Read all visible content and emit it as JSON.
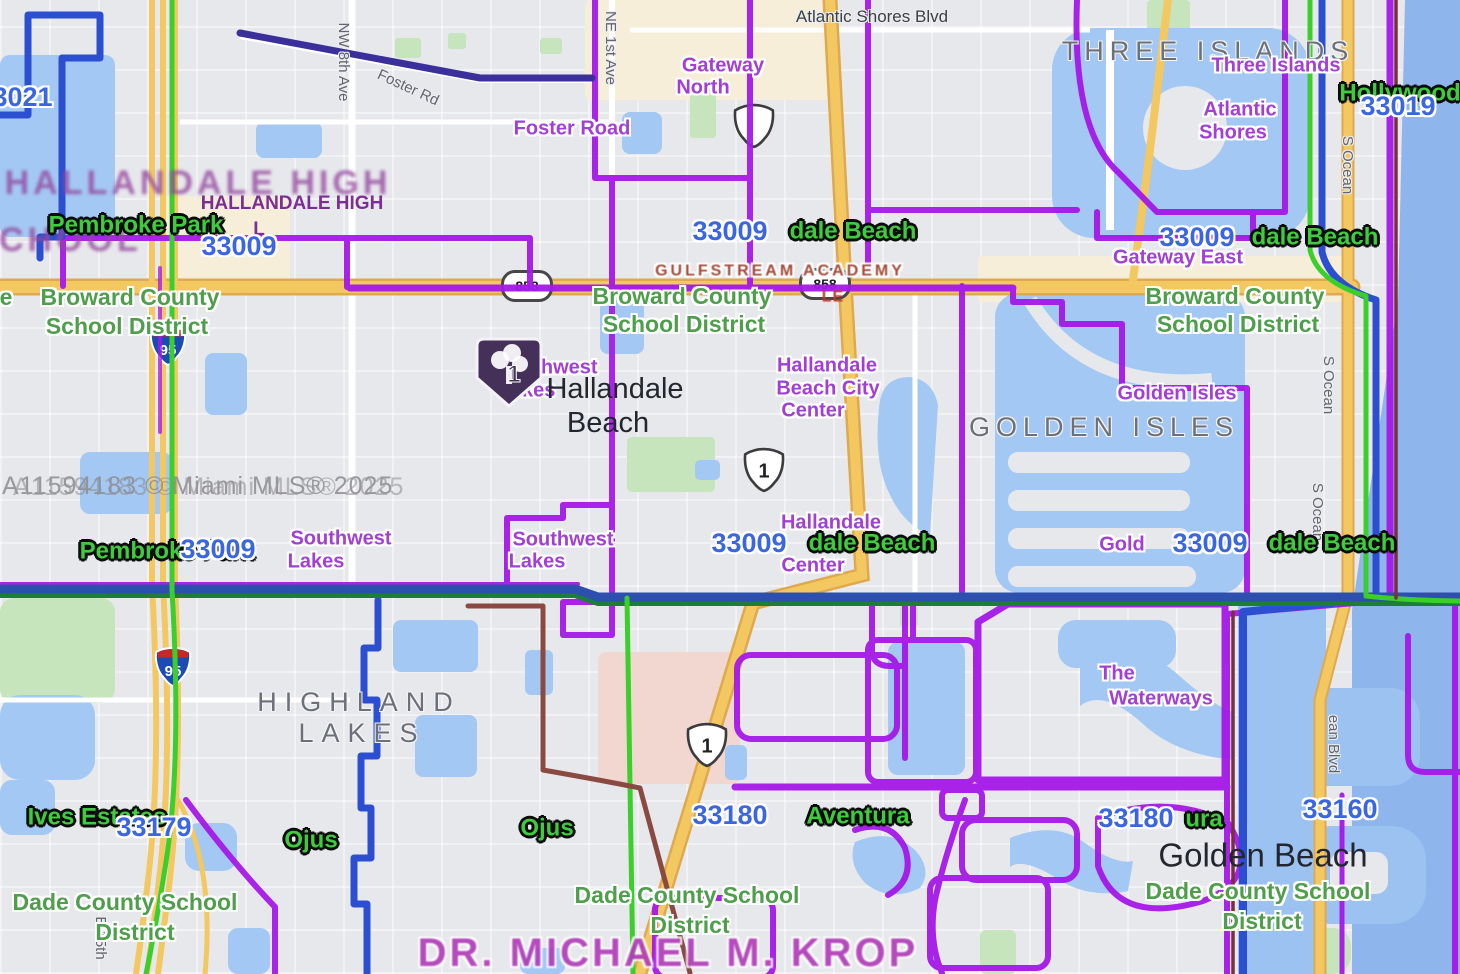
{
  "colors": {
    "zip_label": "#3a66e4",
    "city_label": "#3ecb3e",
    "school_district_label": "#4f9e4c",
    "neighborhood_label": "#a13fd6",
    "boundary_purple": "#a518e8",
    "boundary_blue": "#2b4fd0",
    "boundary_green": "#3bcf2b",
    "county_line_blue": "#2d4fae",
    "road_yellow": "#f3c860",
    "water": "#a3c8f3",
    "ocean": "#8fb6ec",
    "park": "#c6e5bc",
    "marker_fill": "#443058"
  },
  "attribution": "A11594183 © Miami MLS® 2025",
  "marker": {
    "count": "1"
  },
  "shields": {
    "sr858": "858",
    "us1": "1",
    "us1_blank": "",
    "i95": "95"
  },
  "labels": {
    "zip_33021": "33021",
    "road_atlantic_shores_blvd": "Atlantic Shores Blvd",
    "area_three_islands": "THREE ISLANDS",
    "nbhd_three_islands": "Three Islands",
    "city_hollywood": "Hollywood",
    "zip_33019": "33019",
    "nbhd_gateway_north_l1": "Gateway",
    "nbhd_gateway_north_l2": "North",
    "nbhd_foster_road": "Foster Road",
    "road_foster_rd": "Foster Rd",
    "road_nw_8th_ave": "NW 8th Ave",
    "road_ne_1st_ave": "NE 1st Ave",
    "nbhd_atlantic_shores_l1": "Atlantic",
    "nbhd_atlantic_shores_l2": "Shores",
    "zip_33009": "33009",
    "frag_dale_beach": "dale Beach",
    "nbhd_gateway_east": "Gateway East",
    "area_hallandale_high_l1": "HALLANDALE HIGH",
    "area_hallandale_high_l2": "SCHOOL",
    "frag_school_l": "L",
    "frag_e": "e",
    "city_pembroke_park": "Pembroke Park",
    "district_broward_l1": "Broward County",
    "district_broward_l2": "School District",
    "school_gulfstream": "GULFSTREAM ACADEMY",
    "frag_le": "LE",
    "nbhd_hbcc_l1": "Hallandale",
    "nbhd_hbcc_l2": "Beach City",
    "nbhd_hbcc_l3": "Center",
    "city_hallandale_l1": "Hallandale",
    "city_hallandale_l2": "Beach",
    "nbhd_southwest_l1": "Southwest",
    "nbhd_southwest_l2": "Lakes",
    "nbhd_golden_isles": "Golden Isles",
    "area_golden_isles": "GOLDEN ISLES",
    "road_s_ocean": "S Ocean",
    "nbhd_hallandale_frag": "Hallandale",
    "nbhd_center_frag": "Center",
    "frag_gold": "Gold",
    "area_highland_l1": "HIGHLAND",
    "area_highland_l2": "LAKES",
    "nbhd_waterways_l1": "The",
    "nbhd_waterways_l2": "Waterways",
    "city_ives_estates": "Ives Estates",
    "zip_33179": "33179",
    "city_ojus": "Ojus",
    "zip_33180": "33180",
    "city_aventura": "Aventura",
    "frag_ura": "ura",
    "zip_33160": "33160",
    "city_golden_beach": "Golden Beach",
    "district_dade_l1": "Dade County School",
    "district_dade_l2": "District",
    "school_krop": "DR. MICHAEL M. KROP",
    "road_e_15th": "E 15th",
    "road_ean_blvd": "ean Blvd"
  }
}
